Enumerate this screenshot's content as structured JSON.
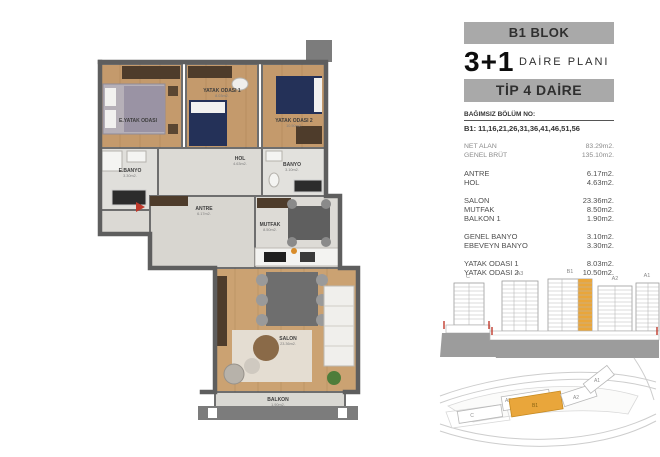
{
  "header": {
    "block_title": "B1 BLOK",
    "plan_type": "3+1",
    "plan_label": "DAİRE PLANI",
    "tip_label": "TİP 4 DAİRE",
    "bagimsiz_label": "BAĞIMSIZ BÖLÜM NO:",
    "bagimsiz_units": "B1: 11,16,21,26,31,36,41,46,51,56"
  },
  "areas": {
    "rows": [
      {
        "label": "NET ALAN",
        "value": "83.29m2."
      },
      {
        "label": "GENEL BRÜT",
        "value": "135.10m2."
      },
      {
        "label": "ANTRE",
        "value": "6.17m2."
      },
      {
        "label": "HOL",
        "value": "4.63m2."
      },
      {
        "label": "SALON",
        "value": "23.36m2."
      },
      {
        "label": "MUTFAK",
        "value": "8.50m2."
      },
      {
        "label": "BALKON 1",
        "value": "1.90m2."
      },
      {
        "label": "GENEL BANYO",
        "value": "3.10m2."
      },
      {
        "label": "EBEVEYN BANYO",
        "value": "3.30m2."
      },
      {
        "label": "YATAK ODASI 1",
        "value": "8.03m2."
      },
      {
        "label": "YATAK ODASI 2",
        "value": "10.50m2."
      }
    ]
  },
  "plan": {
    "rooms": {
      "master": "E.YATAK ODASI",
      "bed1": "YATAK ODASI 1",
      "bed2": "YATAK ODASI 2",
      "ebanyo": "E.BANYO",
      "banyo": "BANYO",
      "hol": "HOL",
      "antre": "ANTRE",
      "mutfak": "MUTFAK",
      "salon": "SALON",
      "balkon": "BALKON"
    }
  },
  "elevation": {
    "labels": {
      "c": "C",
      "a3": "A3",
      "b1": "B1",
      "a2": "A2",
      "a1": "A1"
    }
  },
  "siteplan": {
    "labels": {
      "a3": "A3",
      "b1": "B1",
      "a2": "A2",
      "a1": "A1",
      "c": "C"
    }
  },
  "colors": {
    "highlight": "#e9a63b",
    "bar_bg": "#a9a9a9",
    "wall": "#5e5e5e",
    "entry_arrow": "#c0392b"
  }
}
